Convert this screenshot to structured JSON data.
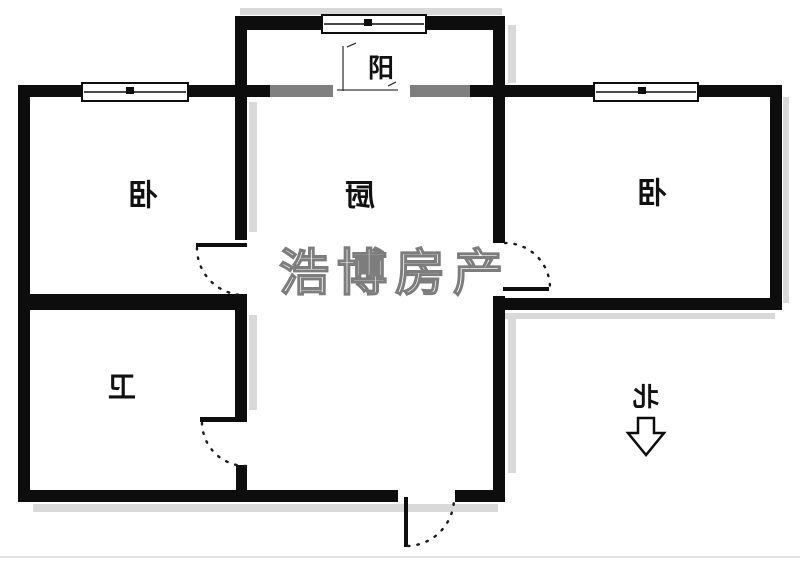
{
  "plan": {
    "type": "apartment-floor-plan",
    "rooms": {
      "bedroom_left": {
        "label": "卧"
      },
      "kitchen": {
        "label": "厨"
      },
      "bedroom_right": {
        "label": "卧"
      },
      "bathroom": {
        "label": "卫"
      },
      "balcony": {
        "label": "阳"
      }
    },
    "compass": {
      "label": "北",
      "arrow_direction": "down"
    },
    "watermark": {
      "text": "浩博房产"
    },
    "colors": {
      "wall": "#0d0d0d",
      "opening_bar": "#7f7f7f",
      "shadow": "#d9d9d9",
      "background": "#ffffff",
      "watermark_outline": "#7d7d7d"
    }
  }
}
